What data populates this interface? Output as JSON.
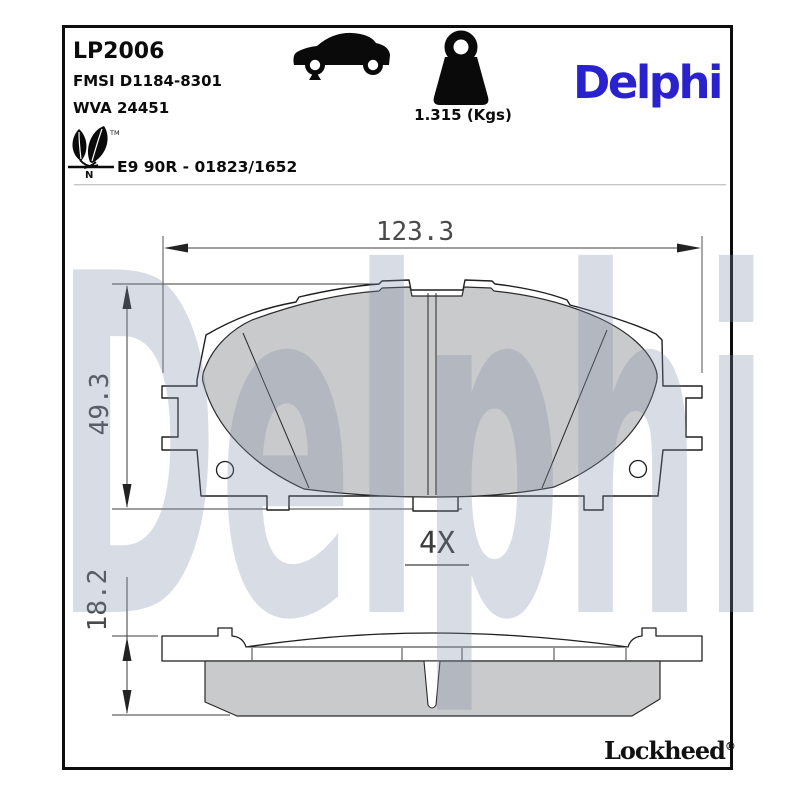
{
  "header": {
    "part_number": "LP2006",
    "fmsi_code": "FMSI D1184-8301",
    "wva_code": "WVA 24451",
    "weight": "1.315 (Kgs)",
    "brand_logo": "Delphi",
    "homologation": "E9 90R - 01823/1652",
    "leaf_tm": "TM",
    "leaf_n": "N"
  },
  "icons": {
    "vehicle": "car-icon",
    "mass": "weight-icon",
    "eco": "eco-leaf-icon"
  },
  "drawing": {
    "width_dim": "123.3",
    "height_dim": "49.3",
    "thickness_dim": "18.2",
    "quantity_label": "4X"
  },
  "watermark": "Delphi",
  "footer": {
    "brand": "Lockheed",
    "registered_mark": "®"
  },
  "colors": {
    "brand_blue": "#2a22cc",
    "pad_fill": "#c9cacc",
    "line": "#1f1f1f",
    "dim_text": "#4a4a4a"
  }
}
